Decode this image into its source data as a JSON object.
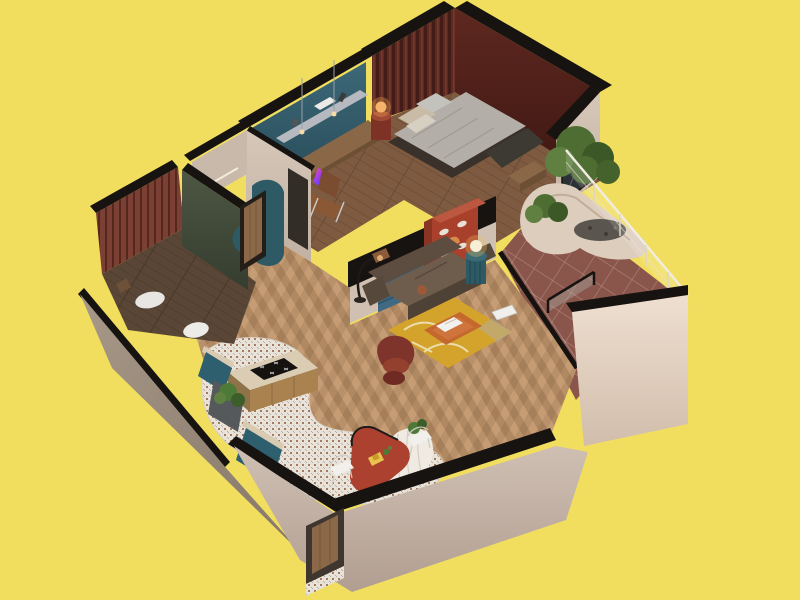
{
  "scene": {
    "description": "Isometric 3D cutaway render of a one-bedroom apartment floor plan on a plain yellow background",
    "rooms": [
      "bedroom",
      "study-nook",
      "bathroom",
      "hallway",
      "living-room",
      "kitchen",
      "dining-area",
      "balcony",
      "entry"
    ],
    "objects": [
      "double-bed",
      "nightstand-lamp",
      "built-in-desk",
      "desk-chair",
      "leather-sofa",
      "yellow-rug",
      "acrylic-coffee-table",
      "laptop",
      "velvet-armchair",
      "fluted-side-table",
      "globe-lamp",
      "arc-floor-lamp",
      "red-sideboard",
      "blue-slat-panel",
      "kitchen-island-cooktop",
      "teal-cabinets",
      "red-capsule-dining-table",
      "wire-chairs",
      "curved-white-shelf",
      "balcony-planter-trees",
      "glass-railing",
      "entry-door",
      "bathroom-sink",
      "toilet"
    ]
  },
  "palette": {
    "background": "#f1de5f",
    "wall_top": "#171310",
    "exterior_left_wall": "#9c8d81",
    "exterior_bottom_wall": "#c7b7ab",
    "parapet_wall": "#e9dacb",
    "bedroom_ne_wall": "#57251d",
    "fluted_headboard_wall": "#6e3328",
    "desk_wall_teal": "#30596a",
    "bedroom_floor": "#7d5a40",
    "living_floor": "#b8906a",
    "bathroom_floor": "#5a4636",
    "bathroom_green_wall": "#47503f",
    "bathroom_slat_wall": "#7c3f33",
    "balcony_tile": "#8a564c",
    "mosaic_floor": "#e9e2d8",
    "interior_wall": "#cfc0b2",
    "rug": "#d4a32c",
    "sofa": "#6e5c4d",
    "armchair": "#7e332b",
    "coffee_table": "#c2622f",
    "sideboard": "#a8402c",
    "blue_panel": "#3f6a82",
    "teal_accent": "#2e5a66",
    "dining_table": "#ad4130",
    "island_counter": "#dacdb4",
    "foliage": "#4e6d33",
    "planter": "#ddcdbd",
    "bed_duvet": "#b3afa8",
    "wood_door": "#8a6848",
    "glass": "#aebab4"
  }
}
